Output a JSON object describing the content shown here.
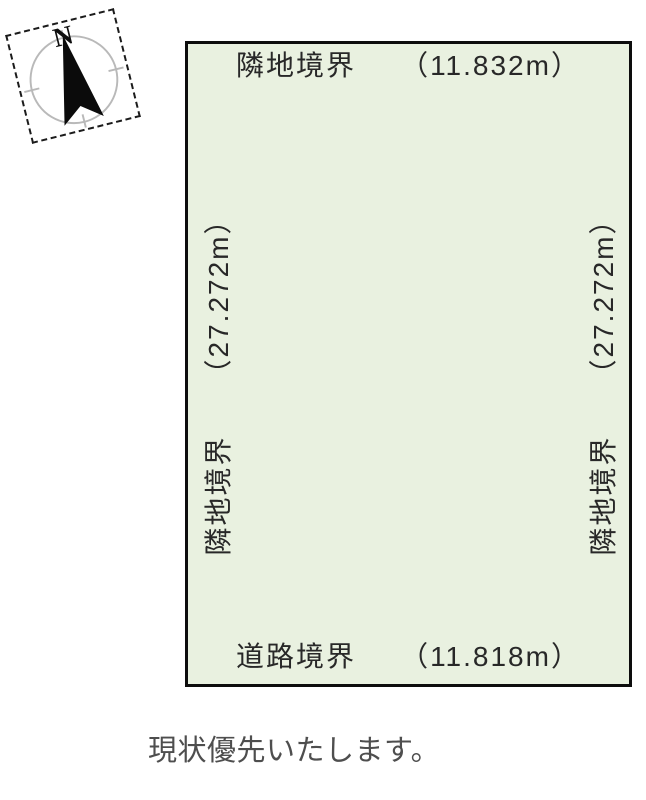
{
  "compass": {
    "north_label": "N",
    "needle_color": "#0b0b0b",
    "ring_color": "#b9b9b9"
  },
  "plot": {
    "fill_color": "#e9f1e0",
    "border_color": "#0d0d0d",
    "boundaries": {
      "top": {
        "name": "隣地境界",
        "length": "（11.832m）"
      },
      "bottom": {
        "name": "道路境界",
        "length": "（11.818m）"
      },
      "left": {
        "name": "隣地境界",
        "length": "（27.272m）"
      },
      "right": {
        "name": "隣地境界",
        "length": "（27.272m）"
      }
    }
  },
  "caption": {
    "text": "現状優先いたします。"
  }
}
